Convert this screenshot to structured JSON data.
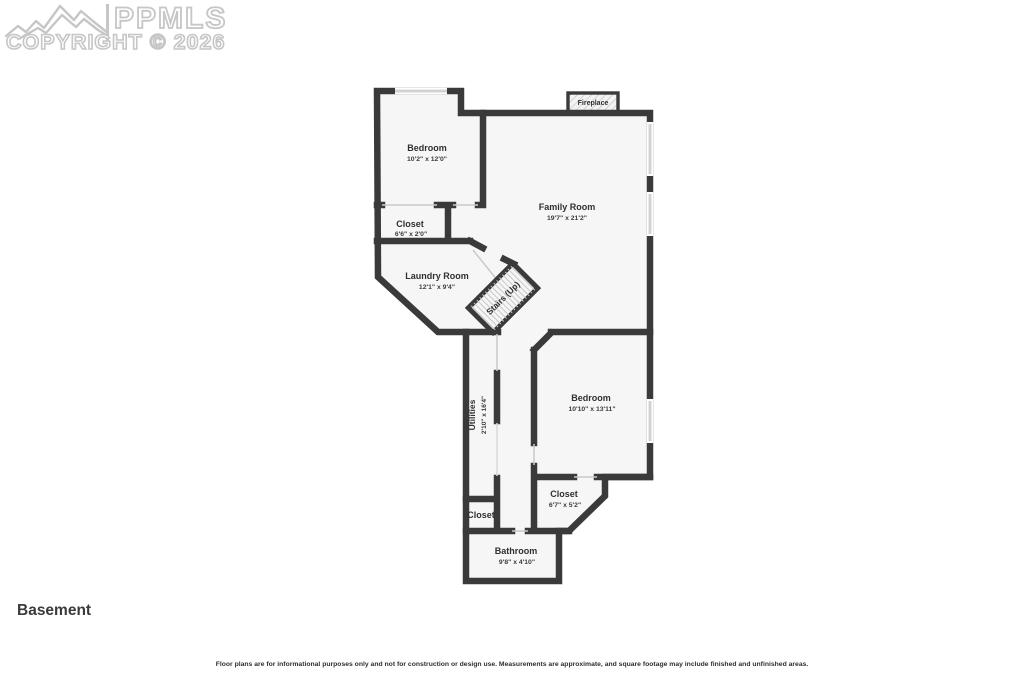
{
  "logo": {
    "brand": "PPMLS",
    "copyright": "COPYRIGHT © 2026"
  },
  "plan": {
    "floor_label": "Basement",
    "fireplace_label": "Fireplace",
    "rooms": [
      {
        "name": "Bedroom",
        "dims": "10'2\" x 12'0\""
      },
      {
        "name": "Closet",
        "dims": "6'6\" x 2'0\""
      },
      {
        "name": "Laundry Room",
        "dims": "12'1\" x 9'4\""
      },
      {
        "name": "Family Room",
        "dims": "19'7\" x 21'2\""
      },
      {
        "name": "Stairs (Up)",
        "dims": ""
      },
      {
        "name": "Utilities",
        "dims": "2'10\" x 16'4\""
      },
      {
        "name": "Bedroom",
        "dims": "10'10\" x 13'11\""
      },
      {
        "name": "Closet",
        "dims": "6'7\" x 5'2\""
      },
      {
        "name": "Closet",
        "dims": ""
      },
      {
        "name": "Bathroom",
        "dims": "9'8\" x 4'10\""
      }
    ]
  },
  "disclaimer": "Floor plans are for informational purposes only and not for construction or design use. Measurements are approximate, and square footage may include finished and unfinished areas.",
  "colors": {
    "wall": "#3a3a3a",
    "floor": "#f6f6f6",
    "window": "#d2d2d2",
    "label": "#303030",
    "watermark": "#c6c6c6"
  }
}
